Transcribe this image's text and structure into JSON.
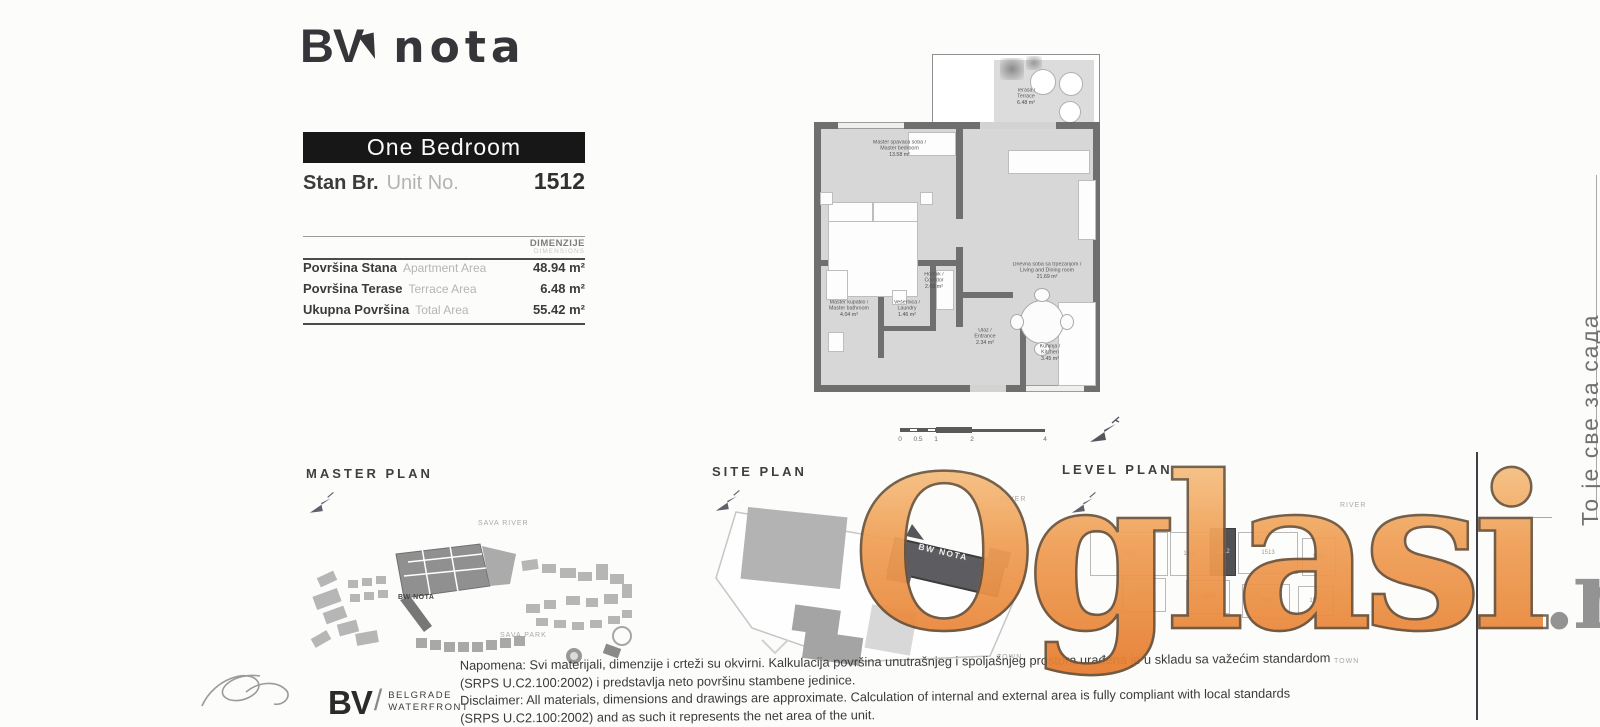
{
  "brand": {
    "bv": "BV",
    "nota": "nota"
  },
  "unit": {
    "banner": "One Bedroom",
    "label_sr": "Stan Br.",
    "label_en": "Unit No.",
    "number": "1512"
  },
  "areas": {
    "header": "DIMENZIJE",
    "header_sub": "DIMENSIONS",
    "rows": [
      {
        "sr": "Površina Stana",
        "en": "Apartment Area",
        "value": "48.94 m²"
      },
      {
        "sr": "Površina Terase",
        "en": "Terrace Area",
        "value": "6.48 m²"
      },
      {
        "sr": "Ukupna Površina",
        "en": "Total Area",
        "value": "55.42 m²"
      }
    ]
  },
  "floor_plan": {
    "rooms": {
      "terrace": {
        "sr": "Terasa /",
        "en": "Terrace",
        "area": "6.48 m²"
      },
      "master_bedroom": {
        "sr": "Master spavaća soba /",
        "en": "Master bedroom",
        "area": "13.58 m²"
      },
      "living": {
        "sr": "Dnevna soba sa trpezarijom /",
        "en": "Living and Dining room",
        "area": "21.69 m²"
      },
      "corridor": {
        "sr": "Hodnik /",
        "en": "Corridor",
        "area": "2.09 m²"
      },
      "laundry": {
        "sr": "Vešernica /",
        "en": "Laundry",
        "area": "1.46 m²"
      },
      "master_bathroom": {
        "sr": "Master kupatilo /",
        "en": "Master bathroom",
        "area": "4.04 m²"
      },
      "kitchen": {
        "sr": "Kuhinja /",
        "en": "Kitchen",
        "area": "3.45 m²"
      },
      "entrance": {
        "sr": "Ulaz /",
        "en": "Entrance",
        "area": "2.34 m²"
      }
    },
    "scale_ticks": [
      "0",
      "0.5",
      "1",
      "2",
      "4"
    ]
  },
  "plans": {
    "master": {
      "title": "MASTER PLAN",
      "river": "SAVA RIVER",
      "project": "BW NOTA",
      "park": "SAVA PARK"
    },
    "site": {
      "title": "SITE PLAN",
      "river": "RIVER",
      "town": "TOWN",
      "building": "BW NOTA"
    },
    "level": {
      "title": "LEVEL PLAN",
      "river": "RIVER",
      "town": "TOWN",
      "units": [
        "1501",
        "1508",
        "1512",
        "1513",
        "1514",
        "1502",
        "1503",
        "1504",
        "1507"
      ]
    }
  },
  "disclaimer": {
    "lines": [
      "Napomena: Svi materijali, dimenzije i crteži su okvirni. Kalkulacija površina unutrašnjeg i spoljašnjeg prostora urađena je u skladu sa važećim standardom",
      "(SRPS U.C2.100:2002) i predstavlja neto površinu stambene jedinice.",
      "Disclaimer: All materials, dimensions and drawings are approximate. Calculation of internal and external area is fully compliant with local standards",
      "(SRPS U.C2.100:2002) and as such it represents the net area of the unit."
    ]
  },
  "footer": {
    "bw": "BV",
    "slash": "/",
    "name1": "BELGRADE",
    "name2": "WATERFRONT"
  },
  "watermark": {
    "main": "Oglasi",
    "suffix": ".rs",
    "orange": "#EF9B51",
    "suffix_color": "#8D8D8D"
  },
  "side_note": "То је све за сада"
}
